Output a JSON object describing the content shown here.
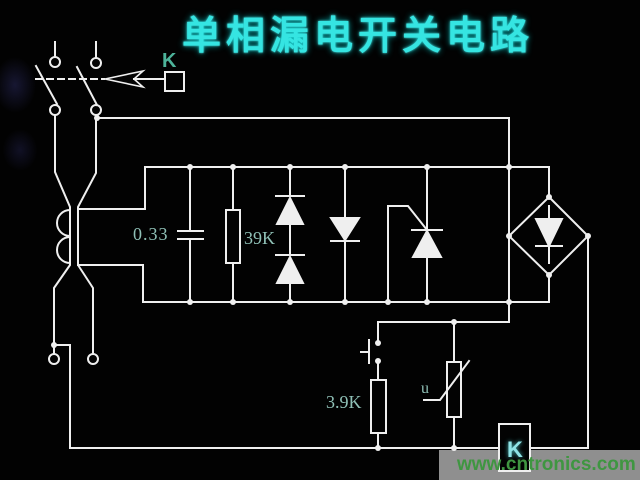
{
  "canvas": {
    "width": 640,
    "height": 480,
    "background": "#020202",
    "wire_color": "#efefef"
  },
  "title": {
    "text": "单相漏电开关电路",
    "color": "#35e5e2",
    "meaning": "Single-phase leakage (earth-leakage) switch circuit"
  },
  "components": {
    "breaker_link_label": "K",
    "capacitor_value": "0.33",
    "shunt_resistor_value": "39K",
    "test_resistor_value": "3.9K",
    "varistor_label": "u",
    "relay_coil_label": "K",
    "parts": [
      "double-pole-knife-switch",
      "trip-linkage-arrow",
      "trip-actuator-box-K",
      "zero-sequence-current-transformer",
      "capacitor-0.33",
      "resistor-39K",
      "series-diode-pair",
      "single-diode",
      "thyristor-with-gate",
      "bridge-rectifier",
      "test-push-button",
      "resistor-3.9K",
      "varistor-u",
      "relay-coil-box-K",
      "line-input-terminals",
      "load-output-terminals"
    ]
  },
  "label_colors": {
    "component_teal": "#8fc0b6",
    "k_top": "#4db39a",
    "k_coil": "#8fe3e6"
  },
  "watermark": {
    "text": "www.cntronics.com",
    "color": "#3f9641",
    "strip_color": "#8f8f8f"
  }
}
